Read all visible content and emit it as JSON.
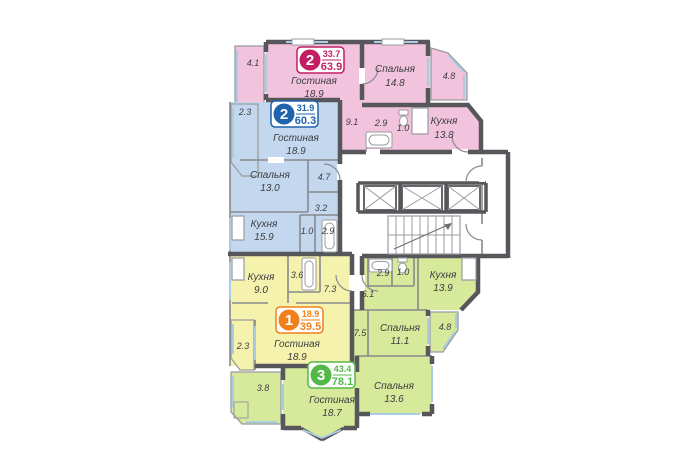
{
  "colors": {
    "apartment_pink": "#f2c3dc",
    "apartment_blue": "#c3d8ee",
    "apartment_yellow": "#f5f2ad",
    "apartment_green": "#d7e99b",
    "badge_pink": "#c31e64",
    "badge_blue": "#1f63ad",
    "badge_orange": "#f08019",
    "badge_green": "#53b848",
    "walls": "#57575b",
    "windows": "#a9cbe3"
  },
  "icons": {
    "elevator": "crossed-box",
    "stairs": "stair-treads-with-arrow",
    "bathtub": "tub-outline",
    "toilet": "toilet-outline"
  },
  "apartments": {
    "pink": {
      "badge": {
        "number": "2",
        "area_living": "33.7",
        "area_total": "63.9"
      },
      "rooms": {
        "living": {
          "name": "Гостиная",
          "area": "18.9"
        },
        "bedroom": {
          "name": "Спальня",
          "area": "14.8"
        },
        "kitchen": {
          "name": "Кухня",
          "area": "13.8"
        },
        "hall": {
          "area": "9.1"
        },
        "bath": {
          "area": "2.9"
        },
        "wc": {
          "area": "1.0"
        },
        "balcony_left": {
          "area": "4.1"
        },
        "balcony_right": {
          "area": "4.8"
        }
      }
    },
    "blue": {
      "badge": {
        "number": "2",
        "area_living": "31.9",
        "area_total": "60.3"
      },
      "rooms": {
        "living": {
          "name": "Гостиная",
          "area": "18.9"
        },
        "bedroom": {
          "name": "Спальня",
          "area": "13.0"
        },
        "kitchen": {
          "name": "Кухня",
          "area": "15.9"
        },
        "hall": {
          "area": "4.7"
        },
        "hall2": {
          "area": "3.2"
        },
        "bath": {
          "area": "2.9"
        },
        "wc": {
          "area": "1.0"
        },
        "balcony": {
          "area": "2.3"
        }
      }
    },
    "yellow": {
      "badge": {
        "number": "1",
        "area_living": "18.9",
        "area_total": "39.5"
      },
      "rooms": {
        "living": {
          "name": "Гостиная",
          "area": "18.9"
        },
        "kitchen": {
          "name": "Кухня",
          "area": "9.0"
        },
        "bath": {
          "area": "3.6"
        },
        "hall": {
          "area": "7.3"
        },
        "balcony": {
          "area": "2.3"
        }
      }
    },
    "green": {
      "badge": {
        "number": "3",
        "area_living": "43.4",
        "area_total": "78.1"
      },
      "rooms": {
        "living": {
          "name": "Гостиная",
          "area": "18.7"
        },
        "bedroom1": {
          "name": "Спальня",
          "area": "11.1"
        },
        "bedroom2": {
          "name": "Спальня",
          "area": "13.6"
        },
        "kitchen": {
          "name": "Кухня",
          "area": "13.9"
        },
        "hall": {
          "area": "7.5"
        },
        "hall2": {
          "area": "6.1"
        },
        "bath": {
          "area": "2.9"
        },
        "wc": {
          "area": "1.0"
        },
        "balcony_left": {
          "area": "3.8"
        },
        "balcony_right": {
          "area": "4.8"
        }
      }
    }
  }
}
